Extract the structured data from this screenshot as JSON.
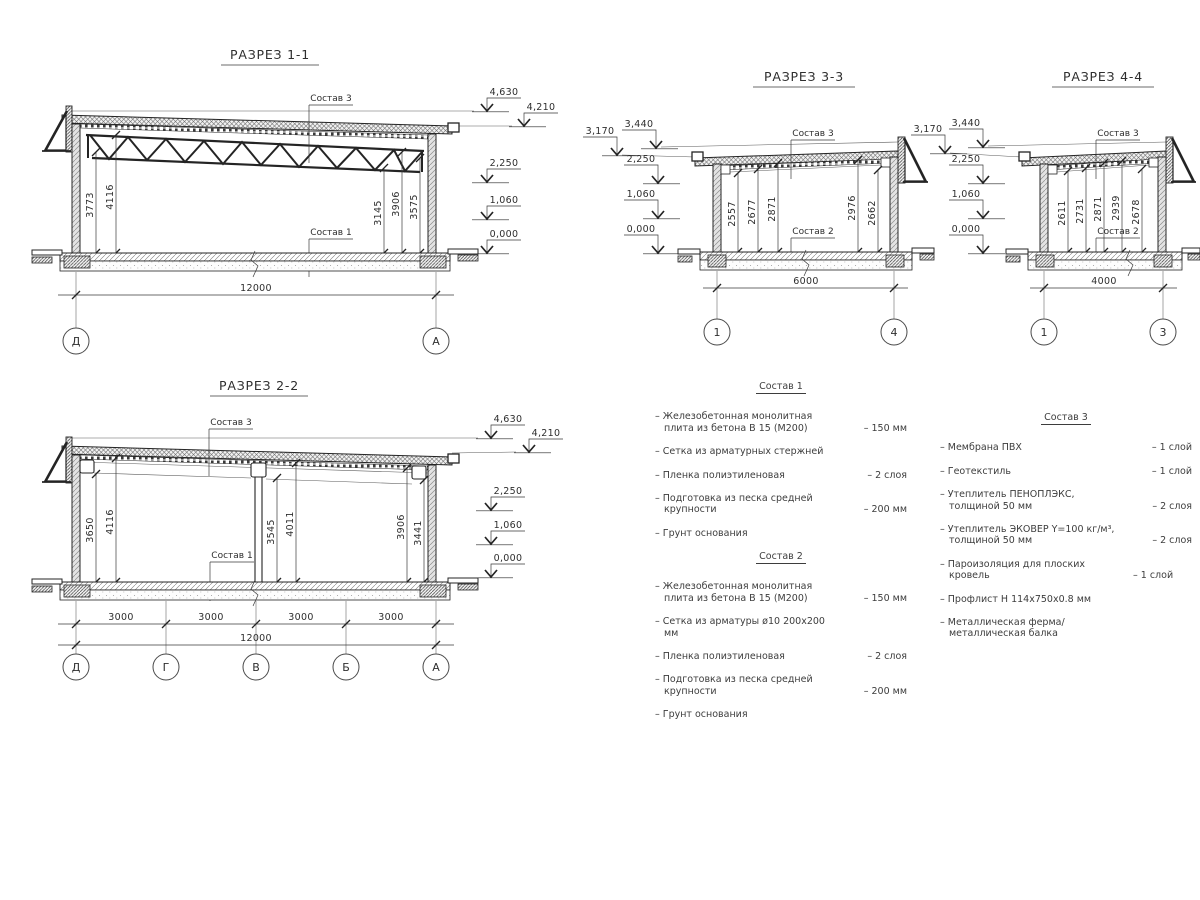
{
  "drawing": {
    "s1": {
      "title": "РАЗРЕЗ 1-1",
      "label_roof": "Состав 3",
      "label_floor": "Состав 1",
      "dims": [
        "3773",
        "4116",
        "3145",
        "3906",
        "3575"
      ],
      "span": "12000",
      "grids": [
        "Д",
        "А"
      ],
      "elev": [
        "4,630",
        "4,210",
        "2,250",
        "1,060",
        "0,000"
      ]
    },
    "s2": {
      "title": "РАЗРЕЗ 2-2",
      "label_roof": "Состав 3",
      "label_floor": "Состав 1",
      "dims": [
        "3650",
        "4116",
        "3545",
        "4011",
        "3906",
        "3441"
      ],
      "spans": [
        "3000",
        "3000",
        "3000",
        "3000"
      ],
      "span_total": "12000",
      "grids": [
        "Д",
        "Г",
        "В",
        "Б",
        "А"
      ],
      "elev": [
        "4,630",
        "4,210",
        "2,250",
        "1,060",
        "0,000"
      ]
    },
    "s3": {
      "title": "РАЗРЕЗ 3-3",
      "label_roof": "Состав 3",
      "label_floor": "Состав 2",
      "dims": [
        "2557",
        "2677",
        "2871",
        "2976",
        "2662"
      ],
      "span": "6000",
      "grids": [
        "1",
        "4"
      ],
      "elev": [
        "3,170",
        "3,440",
        "2,250",
        "1,060",
        "0,000"
      ]
    },
    "s4": {
      "title": "РАЗРЕЗ 4-4",
      "label_roof": "Состав 3",
      "label_floor": "Состав 2",
      "dims": [
        "2611",
        "2731",
        "2871",
        "2939",
        "2678"
      ],
      "span": "4000",
      "grids": [
        "1",
        "3"
      ],
      "elev": [
        "3,170",
        "3,440",
        "2,250",
        "1,060",
        "0,000"
      ]
    }
  },
  "lists": {
    "comp1": {
      "title": "Состав 1",
      "items": [
        {
          "text": "– Железобетонная  монолитная плита из бетона В 15 (М200)",
          "value": "– 150 мм"
        },
        {
          "text": "– Сетка из арматурных стержней",
          "value": ""
        },
        {
          "text": "– Пленка полиэтиленовая",
          "value": "– 2 слоя"
        },
        {
          "text": "– Подготовка из песка средней крупности",
          "value": "– 200 мм"
        },
        {
          "text": "– Грунт основания",
          "value": ""
        }
      ]
    },
    "comp2": {
      "title": "Состав 2",
      "items": [
        {
          "text": "– Железобетонная  монолитная плита из бетона В 15 (М200)",
          "value": "– 150 мм"
        },
        {
          "text": "– Сетка из арматуры ø10 200х200 мм",
          "value": ""
        },
        {
          "text": "– Пленка полиэтиленовая",
          "value": "– 2 слоя"
        },
        {
          "text": "– Подготовка из песка средней крупности",
          "value": "– 200 мм"
        },
        {
          "text": "– Грунт основания",
          "value": ""
        }
      ]
    },
    "comp3": {
      "title": "Состав 3",
      "items": [
        {
          "text": "– Мембрана ПВХ",
          "value": "– 1 слой"
        },
        {
          "text": "– Геотекстиль",
          "value": "– 1 слой"
        },
        {
          "text": "– Утеплитель ПЕНОПЛЭКС, толщиной 50 мм",
          "value": "– 2 слоя"
        },
        {
          "text": "– Утеплитель ЭКОВЕР Y=100 кг/м³, толщиной 50 мм",
          "value": "– 2 слоя"
        },
        {
          "text": "– Пароизоляция для плоских кровель",
          "value": "– 1 слой"
        },
        {
          "text": "– Профлист Н 114х750х0.8 мм",
          "value": ""
        },
        {
          "text": "– Металлическая ферма/ металлическая балка",
          "value": ""
        }
      ]
    }
  }
}
